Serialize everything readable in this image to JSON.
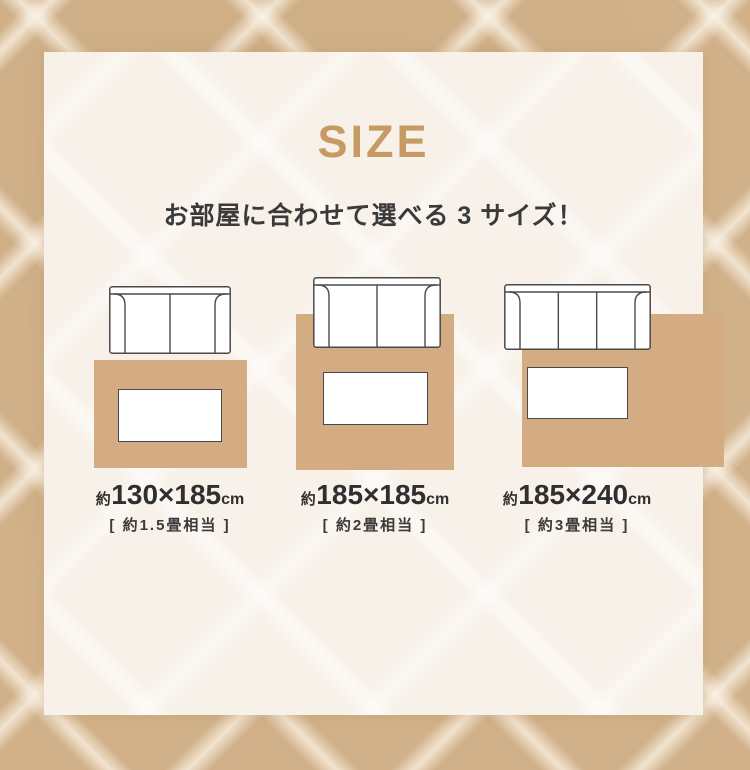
{
  "page": {
    "title": "SIZE",
    "subtitle": "お部屋に合わせて選べる 3 サイズ！"
  },
  "colors": {
    "accent_gold": "#c69b63",
    "rug_tan": "#d3ac83",
    "outline_gray": "#4a4a4a",
    "text_dark": "#3a3a3a",
    "panel_cream": "#f8f1e9",
    "border_beige": "#d1b189"
  },
  "sizes": [
    {
      "approx_prefix": "約",
      "dimensions": "130×185",
      "unit": "cm",
      "tatami_note": "[ 約1.5畳相当 ]",
      "sofa_seats": 2
    },
    {
      "approx_prefix": "約",
      "dimensions": "185×185",
      "unit": "cm",
      "tatami_note": "[ 約2畳相当 ]",
      "sofa_seats": 2
    },
    {
      "approx_prefix": "約",
      "dimensions": "185×240",
      "unit": "cm",
      "tatami_note": "[ 約3畳相当 ]",
      "sofa_seats": 3
    }
  ]
}
